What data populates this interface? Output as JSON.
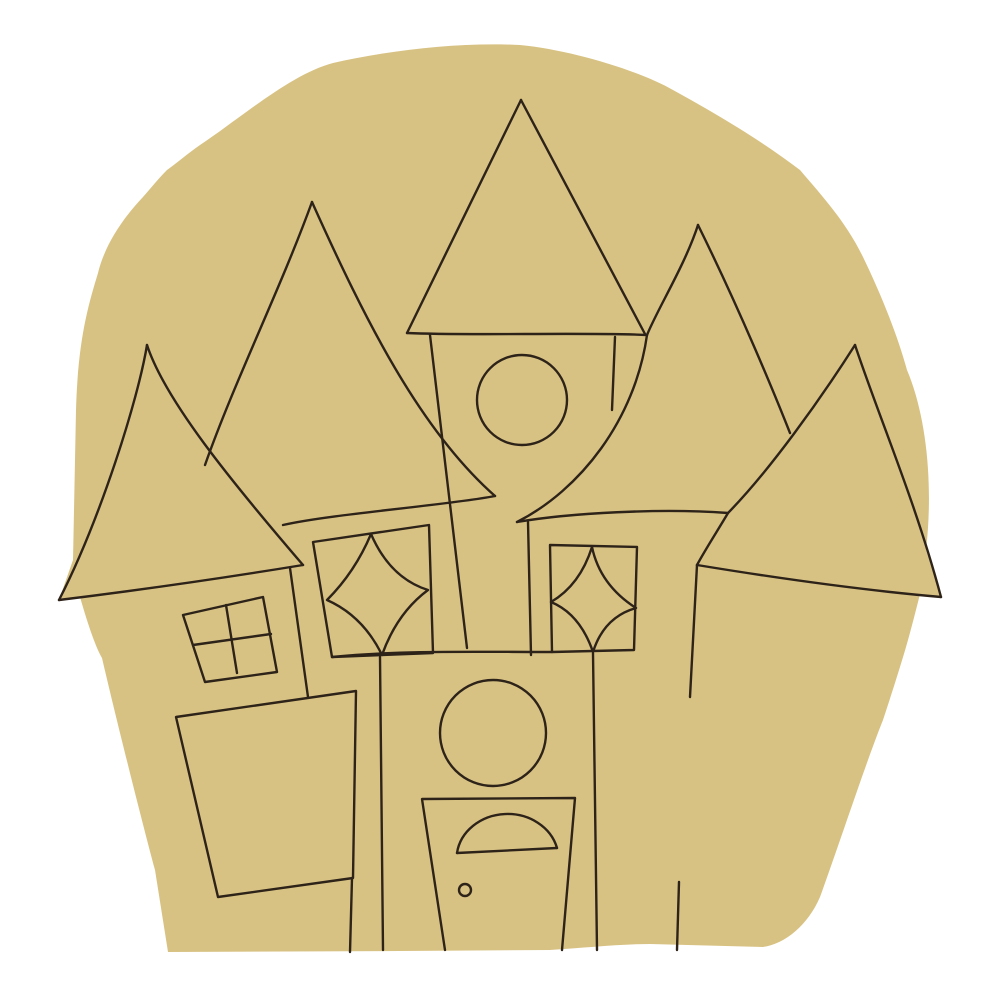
{
  "canvas": {
    "width": 1000,
    "height": 1000,
    "background_color": "#ffffff"
  },
  "artwork": {
    "title": "haunted-house-wood-cutout-line-art",
    "cutout_fill_color": "#d8c283",
    "outline_color": "#2d2319",
    "line_width": "2.4",
    "shapes": [
      "dome-shaped cutout blank",
      "far-left tower roof with protruding eave",
      "left tower roof",
      "tall center tower roof",
      "right tower roof",
      "far-right tower roof with protruding eave",
      "four-pane square window",
      "left diamond (star) window",
      "right diamond (star) window",
      "upper round window",
      "lower round window",
      "left leaning shed block",
      "right leaning shed block",
      "front door with arched window",
      "doorknob"
    ]
  }
}
